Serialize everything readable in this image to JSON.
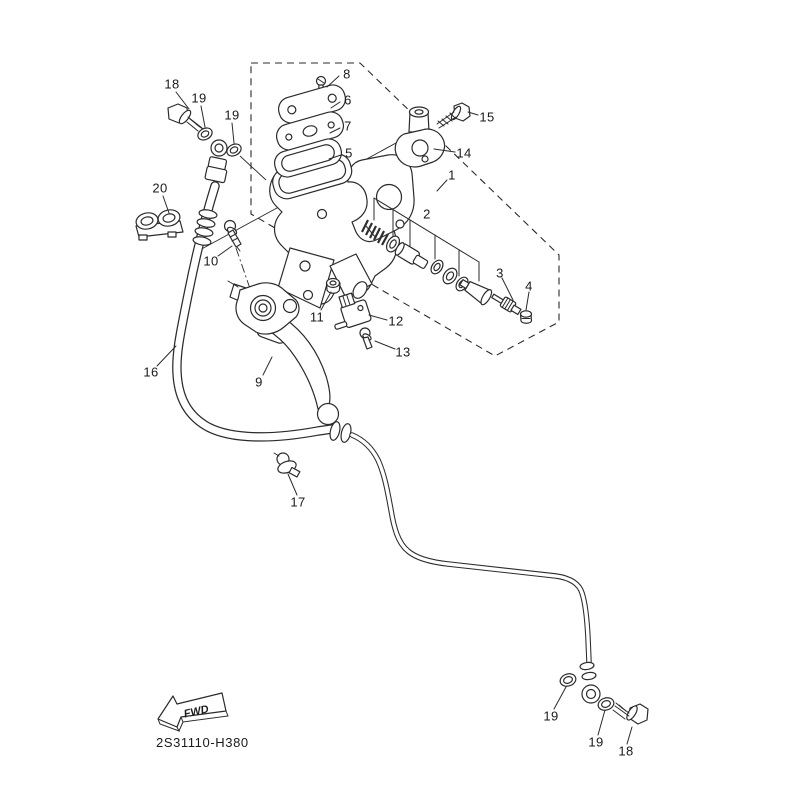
{
  "diagram": {
    "part_code": "2S31110-H380",
    "fwd_label": "FWD",
    "callouts": [
      {
        "ref": "18",
        "x": 172,
        "y": 84
      },
      {
        "ref": "19",
        "x": 199,
        "y": 98
      },
      {
        "ref": "19",
        "x": 232,
        "y": 115
      },
      {
        "ref": "8",
        "x": 347,
        "y": 74
      },
      {
        "ref": "6",
        "x": 348,
        "y": 100
      },
      {
        "ref": "7",
        "x": 348,
        "y": 126
      },
      {
        "ref": "5",
        "x": 349,
        "y": 153
      },
      {
        "ref": "15",
        "x": 487,
        "y": 117
      },
      {
        "ref": "14",
        "x": 464,
        "y": 153
      },
      {
        "ref": "1",
        "x": 452,
        "y": 175
      },
      {
        "ref": "20",
        "x": 160,
        "y": 188
      },
      {
        "ref": "2",
        "x": 427,
        "y": 214
      },
      {
        "ref": "10",
        "x": 211,
        "y": 261
      },
      {
        "ref": "3",
        "x": 500,
        "y": 273
      },
      {
        "ref": "4",
        "x": 529,
        "y": 286
      },
      {
        "ref": "11",
        "x": 317,
        "y": 317
      },
      {
        "ref": "12",
        "x": 396,
        "y": 321
      },
      {
        "ref": "13",
        "x": 403,
        "y": 352
      },
      {
        "ref": "16",
        "x": 151,
        "y": 372
      },
      {
        "ref": "9",
        "x": 259,
        "y": 382
      },
      {
        "ref": "17",
        "x": 298,
        "y": 502
      },
      {
        "ref": "19",
        "x": 551,
        "y": 716
      },
      {
        "ref": "19",
        "x": 596,
        "y": 742
      },
      {
        "ref": "18",
        "x": 626,
        "y": 751
      }
    ]
  },
  "colors": {
    "line": "#2b2b2b",
    "background": "#ffffff",
    "label": "#1a1a1a"
  }
}
